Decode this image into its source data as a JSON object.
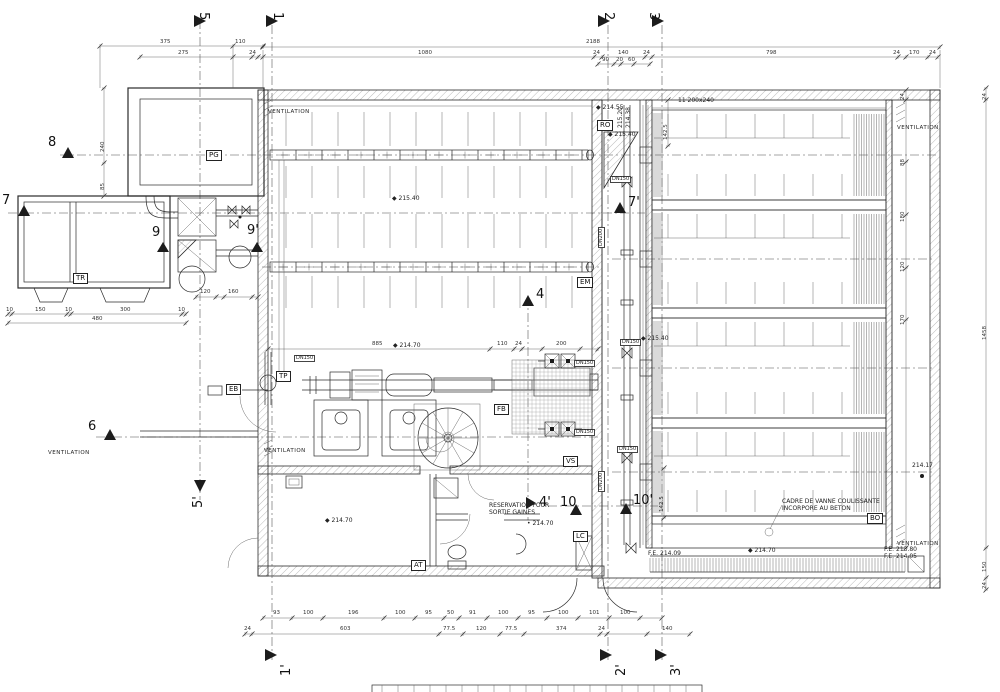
{
  "colors": {
    "line": "#2b2b2b",
    "background": "#ffffff"
  },
  "markers": [
    {
      "id": "5",
      "x": 210,
      "y": 12,
      "r": 90,
      "tri": [
        194,
        15,
        194,
        27,
        206,
        21
      ]
    },
    {
      "id": "1",
      "x": 284,
      "y": 12,
      "r": 90,
      "tri": [
        266,
        15,
        266,
        27,
        278,
        21
      ]
    },
    {
      "id": "2",
      "x": 615,
      "y": 12,
      "r": 90,
      "tri": [
        598,
        15,
        598,
        27,
        610,
        21
      ]
    },
    {
      "id": "3",
      "x": 660,
      "y": 12,
      "r": 90,
      "tri": [
        652,
        15,
        652,
        27,
        664,
        21
      ]
    },
    {
      "id": "8",
      "x": 48,
      "y": 136,
      "r": 0,
      "tri": [
        62,
        158,
        74,
        158,
        68,
        147
      ]
    },
    {
      "id": "7",
      "x": 2,
      "y": 194,
      "r": 0,
      "tri": [
        18,
        216,
        30,
        216,
        24,
        205
      ]
    },
    {
      "id": "9",
      "x": 152,
      "y": 226,
      "r": 0,
      "tri": [
        157,
        252,
        169,
        252,
        163,
        242
      ]
    },
    {
      "id": "9'",
      "x": 247,
      "y": 224,
      "r": 0,
      "tri": [
        251,
        252,
        263,
        252,
        257,
        242
      ]
    },
    {
      "id": "6",
      "x": 88,
      "y": 420,
      "r": 0,
      "tri": [
        104,
        440,
        116,
        440,
        110,
        429
      ]
    },
    {
      "id": "5'",
      "x": 192,
      "y": 508,
      "r": -90,
      "tri": [
        194,
        480,
        206,
        480,
        200,
        492
      ]
    },
    {
      "id": "7'",
      "x": 628,
      "y": 196,
      "r": 0,
      "tri": [
        614,
        213,
        626,
        213,
        620,
        202
      ]
    },
    {
      "id": "4",
      "x": 536,
      "y": 288,
      "r": 0,
      "tri": [
        522,
        306,
        534,
        306,
        528,
        295
      ]
    },
    {
      "id": "4'",
      "x": 539,
      "y": 496,
      "r": 0,
      "tri": [
        526,
        497,
        526,
        509,
        536,
        503
      ]
    },
    {
      "id": "10",
      "x": 560,
      "y": 496,
      "r": 0,
      "tri": [
        570,
        515,
        582,
        515,
        576,
        504
      ]
    },
    {
      "id": "10'",
      "x": 633,
      "y": 494,
      "r": 0,
      "tri": [
        620,
        514,
        632,
        514,
        626,
        503
      ]
    },
    {
      "id": "1'",
      "x": 280,
      "y": 676,
      "r": -90,
      "tri": [
        265,
        649,
        265,
        661,
        277,
        655
      ]
    },
    {
      "id": "2'",
      "x": 615,
      "y": 676,
      "r": -90,
      "tri": [
        600,
        649,
        600,
        661,
        612,
        655
      ]
    },
    {
      "id": "3'",
      "x": 670,
      "y": 676,
      "r": -90,
      "tri": [
        655,
        649,
        655,
        661,
        667,
        655
      ]
    }
  ],
  "tags": [
    {
      "id": "PG",
      "x": 206,
      "y": 150
    },
    {
      "id": "TR",
      "x": 73,
      "y": 273
    },
    {
      "id": "RO",
      "x": 597,
      "y": 120
    },
    {
      "id": "EB",
      "x": 226,
      "y": 384
    },
    {
      "id": "TP",
      "x": 276,
      "y": 371
    },
    {
      "id": "EM",
      "x": 577,
      "y": 277
    },
    {
      "id": "FB",
      "x": 494,
      "y": 404
    },
    {
      "id": "VS",
      "x": 563,
      "y": 456
    },
    {
      "id": "LC",
      "x": 573,
      "y": 531
    },
    {
      "id": "AT",
      "x": 411,
      "y": 560
    },
    {
      "id": "BO",
      "x": 867,
      "y": 513
    }
  ],
  "labels": [
    {
      "t": "VENTILATION",
      "x": 268,
      "y": 110,
      "c": "vt"
    },
    {
      "t": "VENTILATION",
      "x": 897,
      "y": 126,
      "c": "vt"
    },
    {
      "t": "VENTILATION",
      "x": 264,
      "y": 449,
      "c": "vt"
    },
    {
      "t": "VENTILATION",
      "x": 48,
      "y": 451,
      "c": "vt"
    },
    {
      "t": "VENTILATION",
      "x": 897,
      "y": 542,
      "c": "vt"
    },
    {
      "t": "CADRE DE VANNE COULISSANTE",
      "x": 782,
      "y": 499,
      "c": "nt"
    },
    {
      "t": "INCORPORE AU BETON",
      "x": 782,
      "y": 506,
      "c": "nt"
    },
    {
      "t": "RESERVATION POUR",
      "x": 489,
      "y": 503,
      "c": "nt"
    },
    {
      "t": "SORTIE GAINES",
      "x": 489,
      "y": 510,
      "c": "nt"
    },
    {
      "t": "11 200x240",
      "x": 678,
      "y": 98,
      "c": "nt"
    },
    {
      "t": "◆ 215.40",
      "x": 392,
      "y": 196,
      "c": "lv"
    },
    {
      "t": "◆ 214.70",
      "x": 393,
      "y": 343,
      "c": "lv"
    },
    {
      "t": "◆ 215.40",
      "x": 608,
      "y": 132,
      "c": "lv"
    },
    {
      "t": "◆ 214.55",
      "x": 596,
      "y": 105,
      "c": "lv"
    },
    {
      "t": "◆ 215.40",
      "x": 641,
      "y": 336,
      "c": "lv"
    },
    {
      "t": "◆ 214.70",
      "x": 748,
      "y": 548,
      "c": "lv"
    },
    {
      "t": "F.E. 214.09",
      "x": 648,
      "y": 551,
      "c": "lv"
    },
    {
      "t": "F.E. 213.80",
      "x": 884,
      "y": 547,
      "c": "lv"
    },
    {
      "t": "F.E. 214.05",
      "x": 884,
      "y": 554,
      "c": "lv"
    },
    {
      "t": "214.17",
      "x": 912,
      "y": 463,
      "c": "lv"
    },
    {
      "t": "◆ 214.70",
      "x": 325,
      "y": 518,
      "c": "lv"
    },
    {
      "t": "• 214.70",
      "x": 527,
      "y": 521,
      "c": "lv"
    },
    {
      "t": "215.20",
      "x": 618,
      "y": 128,
      "r": -90,
      "c": "lv"
    },
    {
      "t": "214.38",
      "x": 626,
      "y": 128,
      "r": -90,
      "c": "lv"
    },
    {
      "t": "DN150",
      "x": 294,
      "y": 355,
      "c": "pp"
    },
    {
      "t": "DN150",
      "x": 574,
      "y": 360,
      "c": "pp"
    },
    {
      "t": "DN150",
      "x": 574,
      "y": 429,
      "c": "pp"
    },
    {
      "t": "DN150",
      "x": 620,
      "y": 339,
      "c": "pp"
    },
    {
      "t": "DN150",
      "x": 617,
      "y": 446,
      "c": "pp"
    },
    {
      "t": "DN150",
      "x": 610,
      "y": 176,
      "c": "pp"
    },
    {
      "t": "DN200",
      "x": 598,
      "y": 248,
      "r": -90,
      "c": "pp"
    },
    {
      "t": "DN200",
      "x": 598,
      "y": 492,
      "r": -90,
      "c": "pp"
    },
    {
      "t": "2188",
      "x": 586,
      "y": 40,
      "c": "dm"
    },
    {
      "t": "375",
      "x": 160,
      "y": 40,
      "c": "dm"
    },
    {
      "t": "110",
      "x": 235,
      "y": 40,
      "c": "dm"
    },
    {
      "t": "275",
      "x": 178,
      "y": 51,
      "c": "dm"
    },
    {
      "t": "24",
      "x": 249,
      "y": 51,
      "c": "dm"
    },
    {
      "t": "1080",
      "x": 418,
      "y": 51,
      "c": "dm"
    },
    {
      "t": "24",
      "x": 593,
      "y": 51,
      "c": "dm"
    },
    {
      "t": "140",
      "x": 618,
      "y": 51,
      "c": "dm"
    },
    {
      "t": "24",
      "x": 643,
      "y": 51,
      "c": "dm"
    },
    {
      "t": "798",
      "x": 766,
      "y": 51,
      "c": "dm"
    },
    {
      "t": "24",
      "x": 893,
      "y": 51,
      "c": "dm"
    },
    {
      "t": "170",
      "x": 909,
      "y": 51,
      "c": "dm"
    },
    {
      "t": "24",
      "x": 929,
      "y": 51,
      "c": "dm"
    },
    {
      "t": "90",
      "x": 602,
      "y": 58,
      "c": "dm"
    },
    {
      "t": "20",
      "x": 616,
      "y": 58,
      "c": "dm"
    },
    {
      "t": "60",
      "x": 628,
      "y": 58,
      "c": "dm"
    },
    {
      "t": "240",
      "x": 101,
      "y": 152,
      "r": -90,
      "c": "dm"
    },
    {
      "t": "85",
      "x": 101,
      "y": 190,
      "r": -90,
      "c": "dm"
    },
    {
      "t": "10",
      "x": 6,
      "y": 308,
      "c": "dm"
    },
    {
      "t": "150",
      "x": 35,
      "y": 308,
      "c": "dm"
    },
    {
      "t": "10",
      "x": 65,
      "y": 308,
      "c": "dm"
    },
    {
      "t": "300",
      "x": 120,
      "y": 308,
      "c": "dm"
    },
    {
      "t": "10",
      "x": 178,
      "y": 308,
      "c": "dm"
    },
    {
      "t": "480",
      "x": 92,
      "y": 317,
      "c": "dm"
    },
    {
      "t": "120",
      "x": 200,
      "y": 290,
      "c": "dm"
    },
    {
      "t": "160",
      "x": 228,
      "y": 290,
      "c": "dm"
    },
    {
      "t": "885",
      "x": 372,
      "y": 342,
      "c": "dm"
    },
    {
      "t": "110",
      "x": 497,
      "y": 342,
      "c": "dm"
    },
    {
      "t": "24",
      "x": 515,
      "y": 342,
      "c": "dm"
    },
    {
      "t": "200",
      "x": 556,
      "y": 342,
      "c": "dm"
    },
    {
      "t": "93",
      "x": 273,
      "y": 611,
      "c": "dm"
    },
    {
      "t": "100",
      "x": 303,
      "y": 611,
      "c": "dm"
    },
    {
      "t": "196",
      "x": 348,
      "y": 611,
      "c": "dm"
    },
    {
      "t": "100",
      "x": 395,
      "y": 611,
      "c": "dm"
    },
    {
      "t": "95",
      "x": 425,
      "y": 611,
      "c": "dm"
    },
    {
      "t": "50",
      "x": 447,
      "y": 611,
      "c": "dm"
    },
    {
      "t": "91",
      "x": 469,
      "y": 611,
      "c": "dm"
    },
    {
      "t": "100",
      "x": 498,
      "y": 611,
      "c": "dm"
    },
    {
      "t": "95",
      "x": 528,
      "y": 611,
      "c": "dm"
    },
    {
      "t": "100",
      "x": 558,
      "y": 611,
      "c": "dm"
    },
    {
      "t": "101",
      "x": 589,
      "y": 611,
      "c": "dm"
    },
    {
      "t": "100",
      "x": 620,
      "y": 611,
      "c": "dm"
    },
    {
      "t": "24",
      "x": 244,
      "y": 627,
      "c": "dm"
    },
    {
      "t": "603",
      "x": 340,
      "y": 627,
      "c": "dm"
    },
    {
      "t": "77.5",
      "x": 443,
      "y": 627,
      "c": "dm"
    },
    {
      "t": "120",
      "x": 476,
      "y": 627,
      "c": "dm"
    },
    {
      "t": "77.5",
      "x": 505,
      "y": 627,
      "c": "dm"
    },
    {
      "t": "374",
      "x": 556,
      "y": 627,
      "c": "dm"
    },
    {
      "t": "24",
      "x": 598,
      "y": 627,
      "c": "dm"
    },
    {
      "t": "140",
      "x": 662,
      "y": 627,
      "c": "dm"
    },
    {
      "t": "24",
      "x": 901,
      "y": 100,
      "r": -90,
      "c": "dm"
    },
    {
      "t": "88",
      "x": 901,
      "y": 166,
      "r": -90,
      "c": "dm"
    },
    {
      "t": "180",
      "x": 901,
      "y": 222,
      "r": -90,
      "c": "dm"
    },
    {
      "t": "120",
      "x": 901,
      "y": 272,
      "r": -90,
      "c": "dm"
    },
    {
      "t": "170",
      "x": 901,
      "y": 325,
      "r": -90,
      "c": "dm"
    },
    {
      "t": "142.5",
      "x": 664,
      "y": 140,
      "r": -90,
      "c": "dm"
    },
    {
      "t": "142.5",
      "x": 660,
      "y": 512,
      "r": -90,
      "c": "dm"
    },
    {
      "t": "24",
      "x": 983,
      "y": 100,
      "r": -90,
      "c": "dm"
    },
    {
      "t": "1458",
      "x": 983,
      "y": 340,
      "r": -90,
      "c": "dm"
    },
    {
      "t": "150",
      "x": 983,
      "y": 572,
      "r": -90,
      "c": "dm"
    },
    {
      "t": "24",
      "x": 983,
      "y": 589,
      "r": -90,
      "c": "dm"
    }
  ]
}
